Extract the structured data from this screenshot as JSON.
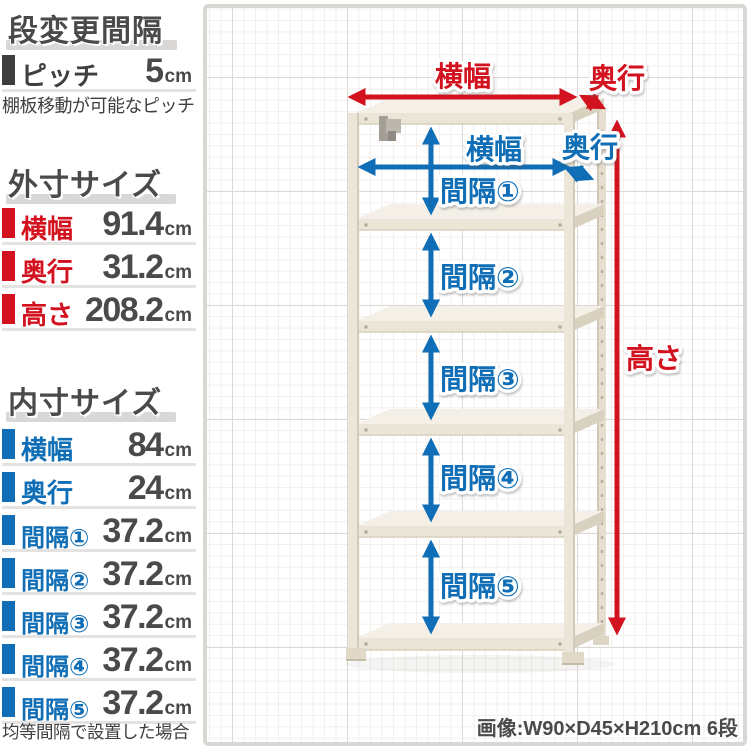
{
  "colors": {
    "red": "#d2121e",
    "blue": "#0f6eb5",
    "text_dark": "#4a4a4a"
  },
  "sidebar": {
    "pitch_section": {
      "title": "段変更間隔",
      "rows": [
        {
          "label": "ピッチ",
          "value": "5",
          "unit": "cm"
        }
      ],
      "note": "棚板移動が可能なピッチ"
    },
    "outer_section": {
      "title": "外寸サイズ",
      "rows": [
        {
          "label": "横幅",
          "value": "91.4",
          "unit": "cm"
        },
        {
          "label": "奥行",
          "value": "31.2",
          "unit": "cm"
        },
        {
          "label": "高さ",
          "value": "208.2",
          "unit": "cm"
        }
      ]
    },
    "inner_section": {
      "title": "内寸サイズ",
      "rows": [
        {
          "label": "横幅",
          "value": "84",
          "unit": "cm"
        },
        {
          "label": "奥行",
          "value": "24",
          "unit": "cm"
        },
        {
          "label": "間隔①",
          "value": "37.2",
          "unit": "cm"
        },
        {
          "label": "間隔②",
          "value": "37.2",
          "unit": "cm"
        },
        {
          "label": "間隔③",
          "value": "37.2",
          "unit": "cm"
        },
        {
          "label": "間隔④",
          "value": "37.2",
          "unit": "cm"
        },
        {
          "label": "間隔⑤",
          "value": "37.2",
          "unit": "cm"
        }
      ],
      "note": "均等間隔で設置した場合"
    }
  },
  "diagram": {
    "outer_width_label": "横幅",
    "outer_depth_label": "奥行",
    "inner_width_label": "横幅",
    "inner_depth_label": "奥行",
    "height_label": "高さ",
    "gap_labels": [
      "間隔①",
      "間隔②",
      "間隔③",
      "間隔④",
      "間隔⑤"
    ],
    "caption": "画像:W90×D45×H210cm 6段"
  }
}
